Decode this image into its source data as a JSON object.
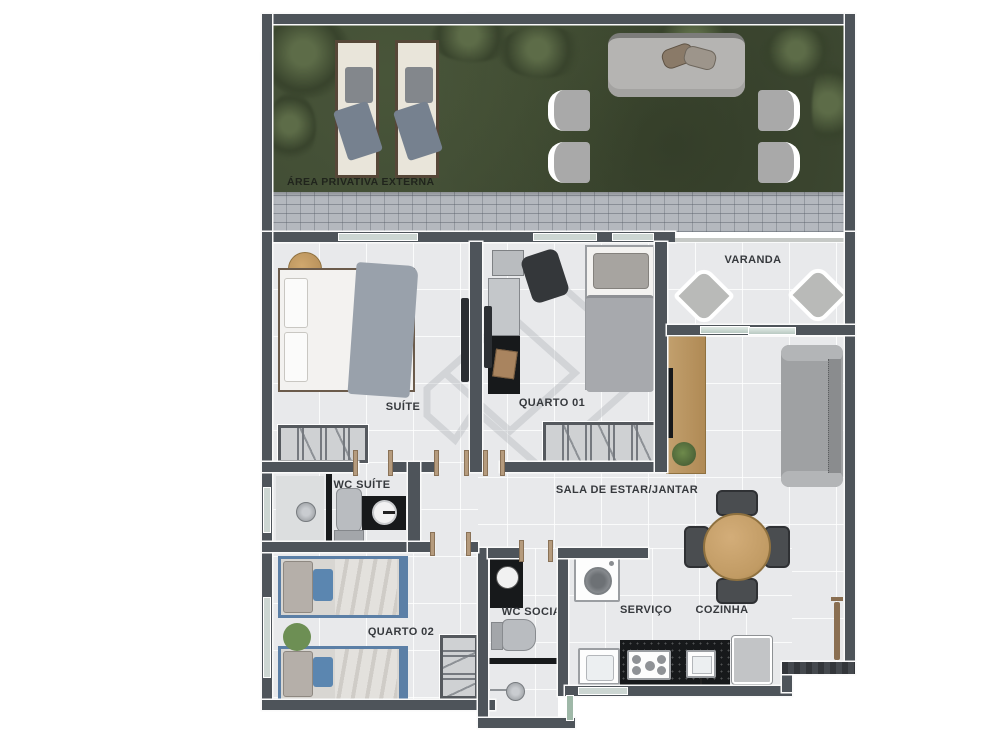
{
  "plan_title": "Apartment floor plan (pt-BR)",
  "outdoor": {
    "label": "ÁREA PRIVATIVA EXTERNA"
  },
  "rooms": {
    "varanda": {
      "label": "VARANDA"
    },
    "suite": {
      "label": "SUÍTE"
    },
    "quarto01": {
      "label": "QUARTO 01"
    },
    "wc_suite": {
      "label": "WC SUÍTE"
    },
    "sala": {
      "label": "SALA DE ESTAR/JANTAR"
    },
    "quarto02": {
      "label": "QUARTO 02"
    },
    "wc_social": {
      "label": "WC SOCIAL"
    },
    "servico": {
      "label": "SERVIÇO"
    },
    "cozinha": {
      "label": "COZINHA"
    }
  },
  "colors": {
    "wall": "#4e545a",
    "floor_tile": "#e8e9eb",
    "grass": "#3f4a33",
    "paving": "#b4b8be",
    "counter_black": "#17191b",
    "wood_accent": "#c19b64",
    "bed_blue": "#5b7fa6",
    "rug_green": "#6d8f54",
    "label_text": "#36393d"
  }
}
